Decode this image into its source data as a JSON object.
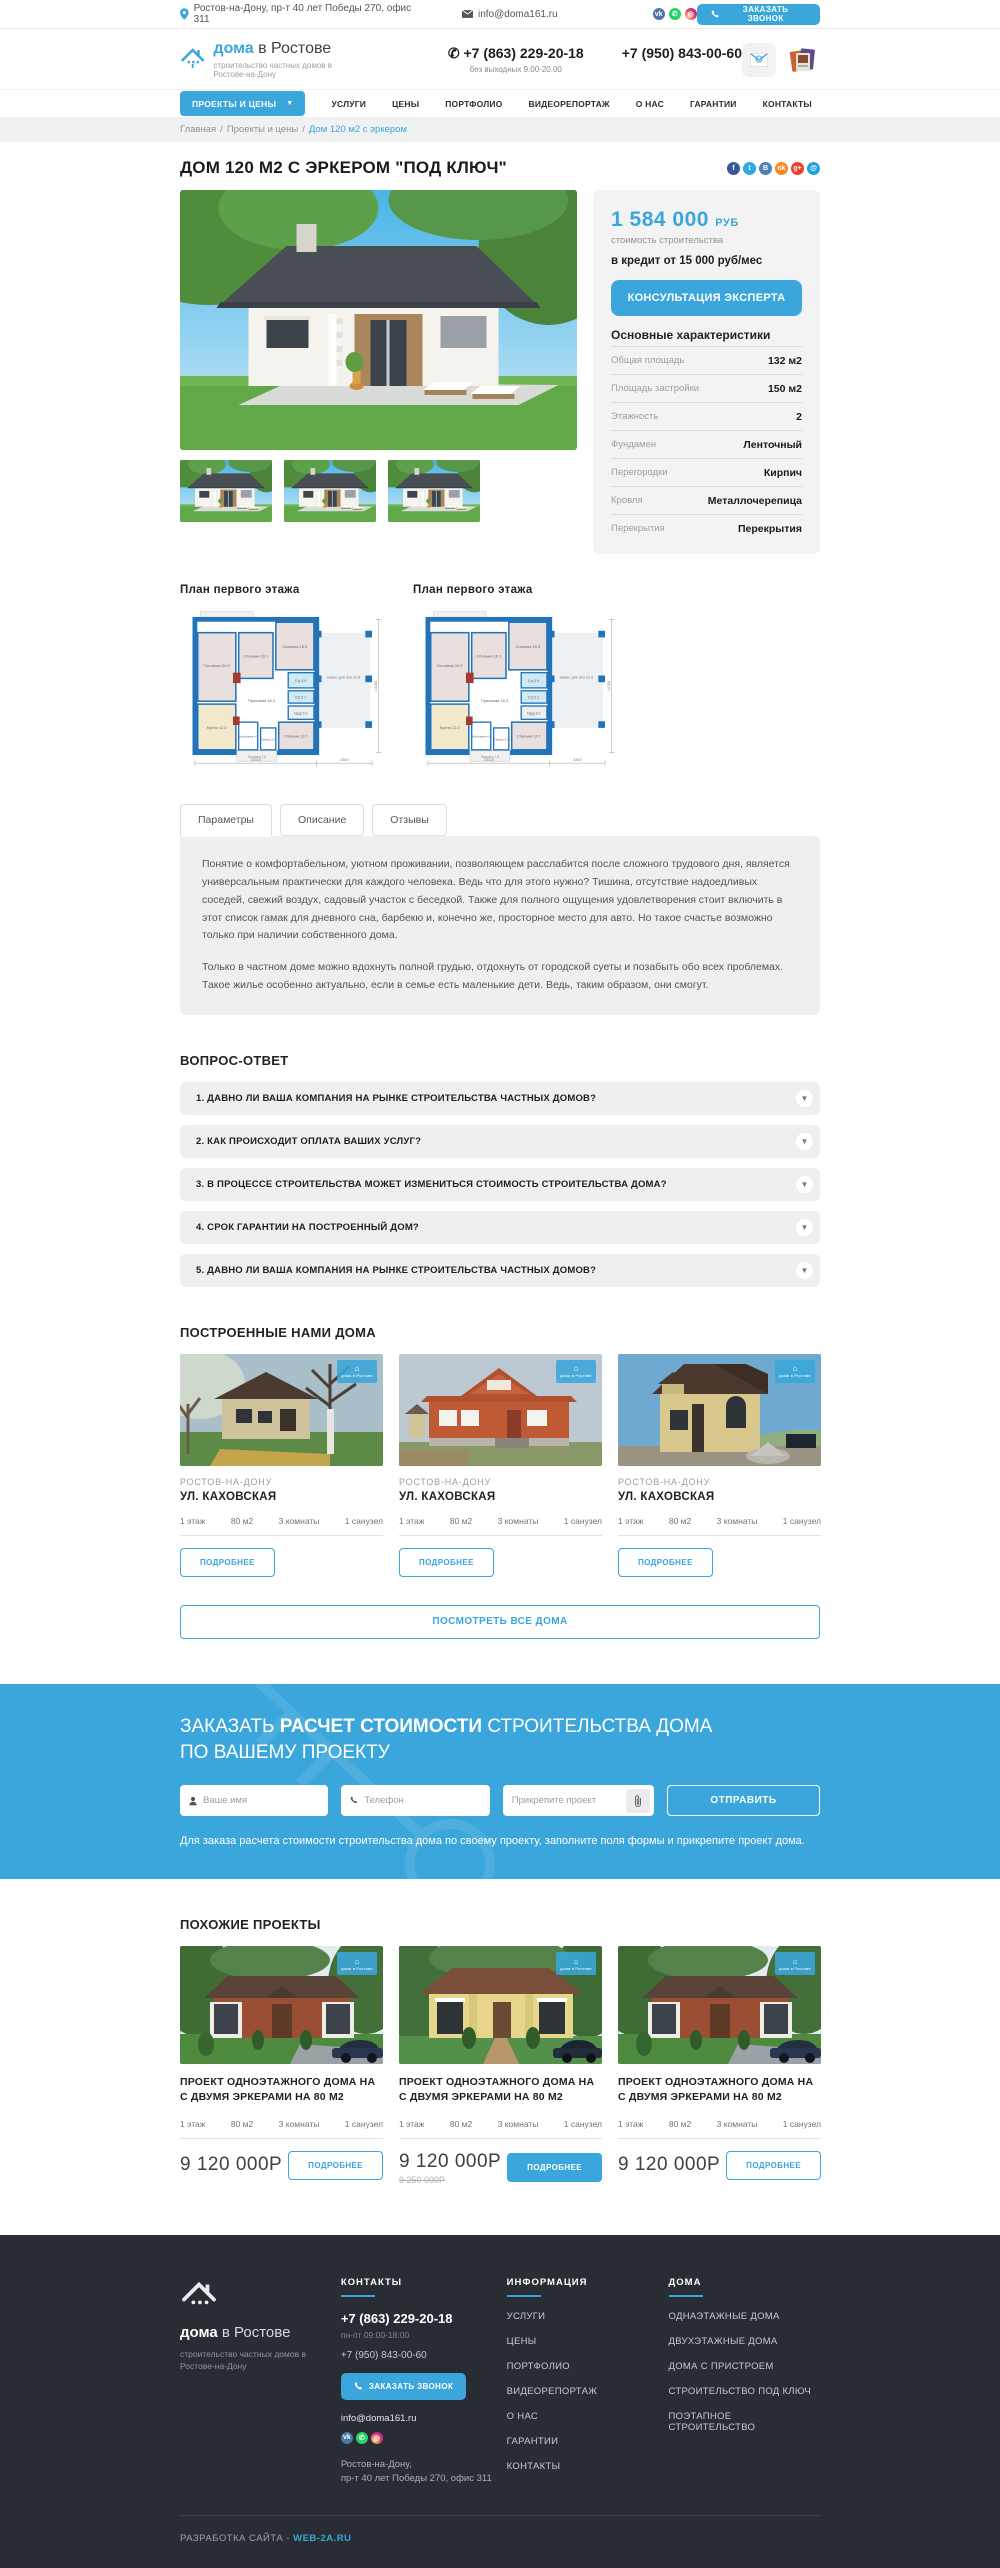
{
  "topbar": {
    "address": "Ростов-на-Дону, пр-т 40 лет Победы 270, офис 311",
    "email": "info@doma161.ru",
    "call_button": "ЗАКАЗАТЬ ЗВОНОК"
  },
  "header": {
    "logo_bold": "дома",
    "logo_light": " в Ростове",
    "tagline": "строительство частных домов в Ростове-на-Дону",
    "phone_main": "+7 (863) 229-20-18",
    "phone_note": "без выходных 9.00-20.00",
    "phone_alt": "+7 (950) 843-00-60"
  },
  "nav": {
    "projects_button": "ПРОЕКТЫ И ЦЕНЫ",
    "items": [
      "УСЛУГИ",
      "ЦЕНЫ",
      "ПОРТФОЛИО",
      "ВИДЕОРЕПОРТАЖ",
      "О НАС",
      "ГАРАНТИИ",
      "КОНТАКТЫ"
    ]
  },
  "breadcrumb": {
    "home": "Главная",
    "section": "Проекты и цены",
    "current": "Дом 120 м2 с эркером",
    "separator": "/"
  },
  "product": {
    "title": "ДОМ 120 М2 С ЭРКЕРОМ \"ПОД КЛЮЧ\"",
    "price": "1 584 000",
    "currency": "РУБ",
    "price_note": "стоимость строительства",
    "credit": "в кредит от 15 000 руб/мес",
    "consult_button": "КОНСУЛЬТАЦИЯ ЭКСПЕРТА",
    "characteristics_title": "Основные характеристики",
    "characteristics": [
      {
        "label": "Общая площадь",
        "value": "132 м2"
      },
      {
        "label": "Площадь застройки",
        "value": "150 м2"
      },
      {
        "label": "Этажность",
        "value": "2"
      },
      {
        "label": "Фундамен",
        "value": "Ленточный"
      },
      {
        "label": "Перегородки",
        "value": "Кирпич"
      },
      {
        "label": "Кровля",
        "value": "Металлочерепица"
      },
      {
        "label": "Перекрытия",
        "value": "Перекрытия"
      }
    ]
  },
  "floor_plans": {
    "left_title": "План первого этажа",
    "right_title": "План первого этажа",
    "rooms": [
      "Терраса 16.2",
      "Гостиная 24.0",
      "Спальня 16.1",
      "Спальня 15.9",
      "С/у 3.9",
      "С/у 2.1",
      "Гард 3.2",
      "Прихожая 16.3",
      "Кухня 12.0",
      "Бойлерная 4.5",
      "Тамбур 2.3",
      "Спальня 13.7",
      "Терраса 7.8",
      "Навес для а/м 31.8"
    ],
    "dims": {
      "width": "13110",
      "carport": "3300",
      "height": "14150"
    }
  },
  "tabs": {
    "items": [
      "Параметры",
      "Описание",
      "Отзывы"
    ]
  },
  "description": {
    "p1": "Понятие о комфортабельном, уютном проживании, позволяющем расслабится после сложного трудового дня, является универсальным практически для каждого человека. Ведь что для этого нужно?  Тишина, отсутствие надоедливых соседей, свежий воздух, садовый участок с беседкой. Также для полного ощущения удовлетворения стоит включить в этот список гамак для дневного сна, барбекю и, конечно же, просторное место для авто. Но такое счастье возможно только при наличии собственного дома.",
    "p2": "Только в частном доме можно вдохнуть полной грудью, отдохнуть от городской суеты и позабыть обо всех проблемах. Такое жилье особенно актуально, если в семье есть маленькие дети. Ведь, таким образом, они смогут."
  },
  "faq": {
    "title": "ВОПРОС-ОТВЕТ",
    "items": [
      "1. ДАВНО ЛИ ВАША КОМПАНИЯ НА РЫНКЕ СТРОИТЕЛЬСТВА ЧАСТНЫХ ДОМОВ?",
      "2. КАК ПРОИСХОДИТ ОПЛАТА ВАШИХ УСЛУГ?",
      "3. В ПРОЦЕССЕ СТРОИТЕЛЬСТВА МОЖЕТ ИЗМЕНИТЬСЯ СТОИМОСТЬ СТРОИТЕЛЬСТВА ДОМА?",
      "4. СРОК ГАРАНТИИ НА ПОСТРОЕННЫЙ ДОМ?",
      "5. ДАВНО ЛИ ВАША КОМПАНИЯ НА РЫНКЕ СТРОИТЕЛЬСТВА ЧАСТНЫХ ДОМОВ?"
    ]
  },
  "built": {
    "title": "ПОСТРОЕННЫЕ НАМИ ДОМА",
    "watermark": "дома в Ростове",
    "items": [
      {
        "city": "РОСТОВ-НА-ДОНУ",
        "street": "УЛ. КАХОВСКАЯ",
        "stats": [
          "1 этаж",
          "80 м2",
          "3 комнаты",
          "1 санузел"
        ],
        "button": "ПОДРОБНЕЕ"
      },
      {
        "city": "РОСТОВ-НА-ДОНУ",
        "street": "УЛ. КАХОВСКАЯ",
        "stats": [
          "1 этаж",
          "80 м2",
          "3 комнаты",
          "1 санузел"
        ],
        "button": "ПОДРОБНЕЕ"
      },
      {
        "city": "РОСТОВ-НА-ДОНУ",
        "street": "УЛ. КАХОВСКАЯ",
        "stats": [
          "1 этаж",
          "80 м2",
          "3 комнаты",
          "1 санузел"
        ],
        "button": "ПОДРОБНЕЕ"
      }
    ],
    "view_all": "ПОСМОТРЕТЬ ВСЕ ДОМА"
  },
  "cta": {
    "title_pre": "ЗАКАЗАТЬ ",
    "title_bold": "РАСЧЕТ СТОИМОСТИ",
    "title_post": " СТРОИТЕЛЬСТВА ДОМА",
    "title_line2": "ПО ВАШЕМУ ПРОЕКТУ",
    "name_placeholder": "Ваше имя",
    "phone_placeholder": "Телефон",
    "file_placeholder": "Прикрепите проект",
    "submit": "ОТПРАВИТЬ",
    "note": "Для заказа расчета стоимости строительства дома по своему проекту, заполните поля формы и прикрепите проект дома."
  },
  "similar": {
    "title": "ПОХОЖИЕ ПРОЕКТЫ",
    "items": [
      {
        "title": "ПРОЕКТ ОДНОЭТАЖНОГО ДОМА НА С ДВУМЯ ЭРКЕРАМИ НА 80 М2",
        "stats": [
          "1 этаж",
          "80 м2",
          "3 комнаты",
          "1 санузел"
        ],
        "price": "9 120 000Р",
        "old_price": "",
        "button": "ПОДРОБНЕЕ"
      },
      {
        "title": "ПРОЕКТ ОДНОЭТАЖНОГО ДОМА НА С ДВУМЯ ЭРКЕРАМИ НА 80 М2",
        "stats": [
          "1 этаж",
          "80 м2",
          "3 комнаты",
          "1 санузел"
        ],
        "price": "9 120 000Р",
        "old_price": "9 250 000Р",
        "button": "ПОДРОБНЕЕ"
      },
      {
        "title": "ПРОЕКТ ОДНОЭТАЖНОГО ДОМА НА С ДВУМЯ ЭРКЕРАМИ НА 80 М2",
        "stats": [
          "1 этаж",
          "80 м2",
          "3 комнаты",
          "1 санузел"
        ],
        "price": "9 120 000Р",
        "old_price": "",
        "button": "ПОДРОБНЕЕ"
      }
    ]
  },
  "footer": {
    "logo_bold": "дома",
    "logo_light": " в Ростове",
    "tagline": "строительство частных домов в Ростове-на-Дону",
    "contacts_title": "КОНТАКТЫ",
    "phone": "+7 (863) 229-20-18",
    "hours": "пн-пт 09:00-18:00",
    "phone2": "+7 (950) 843-00-60",
    "call_button": "ЗАКАЗАТЬ ЗВОНОК",
    "email": "info@doma161.ru",
    "address1": "Ростов-на-Дону,",
    "address2": "пр-т 40 лет Победы 270, офис 311",
    "info_title": "ИНФОРМАЦИЯ",
    "info_links": [
      "УСЛУГИ",
      "ЦЕНЫ",
      "ПОРТФОЛИО",
      "ВИДЕОРЕПОРТАЖ",
      "О НАС",
      "ГАРАНТИИ",
      "КОНТАКТЫ"
    ],
    "houses_title": "ДОМА",
    "houses_links": [
      "ОДНАЭТАЖНЫЕ ДОМА",
      "ДВУХЭТАЖНЫЕ ДОМА",
      "ДОМА С ПРИСТРОЕМ",
      "СТРОИТЕЛЬСТВО ПОД КЛЮЧ",
      "ПОЭТАПНОЕ СТРОИТЕЛЬСТВО"
    ],
    "credits": "РАЗРАБОТКА САЙТА - ",
    "credits_link": "WEB-2A.RU"
  },
  "colors": {
    "accent": "#3aa6db",
    "footer_bg": "#282d33",
    "panel_bg": "#f3f3f3"
  }
}
